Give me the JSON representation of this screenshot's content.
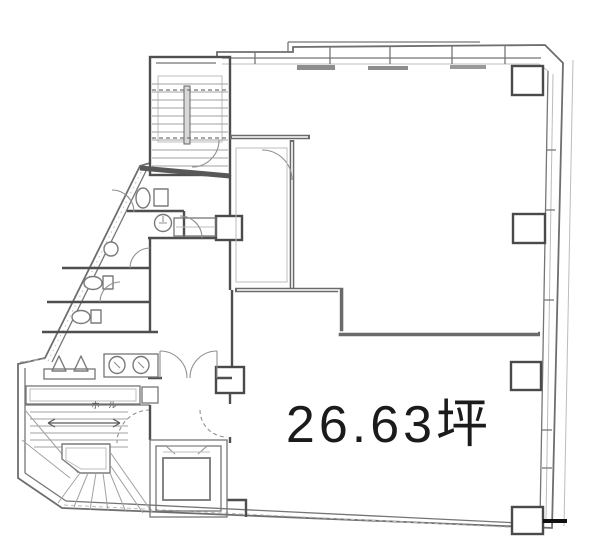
{
  "floorplan": {
    "area_label": "26.63坪",
    "hall_label": "ホール",
    "colors": {
      "background": "#ffffff",
      "wall_line": "#6e6e6e",
      "wall_dark": "#4f4f4f",
      "light_line": "#bcbcbc",
      "label_text": "#1b1b1b",
      "hall_text": "#555555",
      "entry_mark": "#111111"
    },
    "symbols": [
      "staircase-upper",
      "staircase-lower",
      "elevator",
      "toilet",
      "urinal",
      "sink",
      "vanity-basin",
      "double-entry-door",
      "structural-column",
      "window-band"
    ]
  }
}
